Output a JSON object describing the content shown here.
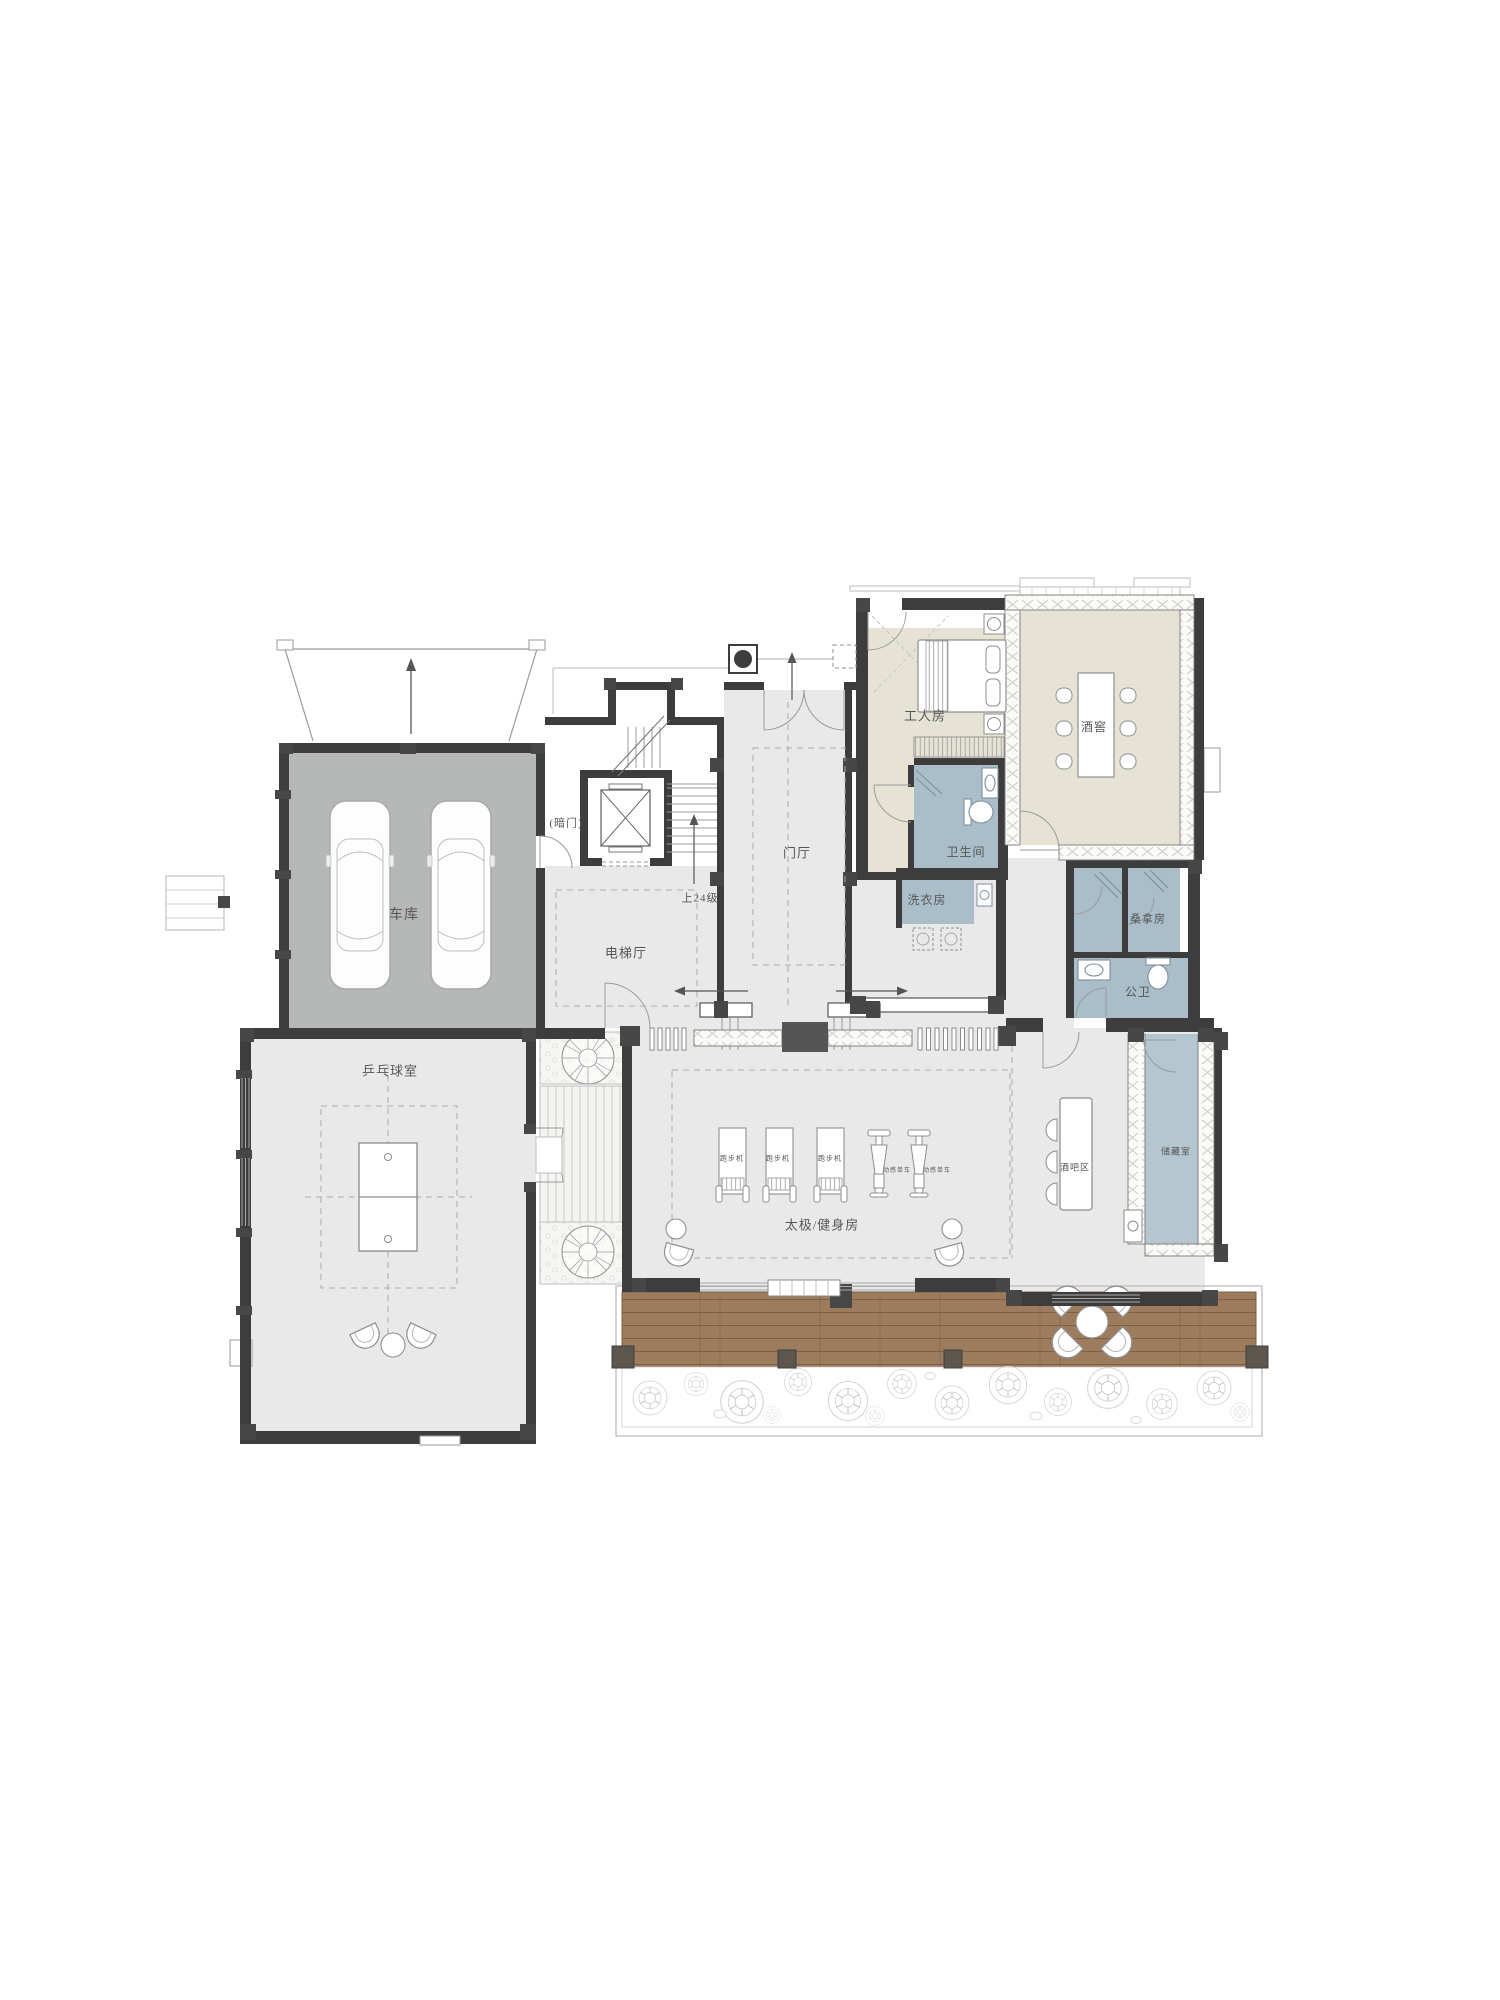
{
  "canvas": {
    "width": 1500,
    "height": 2000,
    "background": "#ffffff"
  },
  "palette": {
    "floor_light": "#e8e9e8",
    "floor_garage": "#b6b8b7",
    "floor_beige": "#e6e3d5",
    "floor_blue": "#a9bec9",
    "floor_storage": "#b4c6d0",
    "deck_wood": "#9d7c5e",
    "wall": "#3d3d3d",
    "pillar": "#474747",
    "text": "#565656"
  },
  "labels": [
    {
      "id": "garage",
      "text": "车库",
      "x": 404,
      "y": 916,
      "fs": 14
    },
    {
      "id": "pingpong-room",
      "text": "乒乓球室",
      "x": 390,
      "y": 1071,
      "fs": 13
    },
    {
      "id": "elevator-hall",
      "text": "电梯厅",
      "x": 626,
      "y": 953,
      "fs": 13
    },
    {
      "id": "foyer",
      "text": "门厅",
      "x": 797,
      "y": 853,
      "fs": 13
    },
    {
      "id": "hidden-door",
      "text": "(暗门)",
      "x": 566,
      "y": 824,
      "fs": 11
    },
    {
      "id": "stairs-up",
      "text": "上24级",
      "x": 700,
      "y": 899,
      "fs": 11
    },
    {
      "id": "worker-room",
      "text": "工人房",
      "x": 925,
      "y": 716,
      "fs": 13
    },
    {
      "id": "bathroom",
      "text": "卫生间",
      "x": 966,
      "y": 852,
      "fs": 12
    },
    {
      "id": "laundry",
      "text": "洗衣房",
      "x": 927,
      "y": 900,
      "fs": 12
    },
    {
      "id": "wine-cellar",
      "text": "酒窖",
      "x": 1094,
      "y": 727,
      "fs": 12
    },
    {
      "id": "sauna",
      "text": "桑拿房",
      "x": 1148,
      "y": 920,
      "fs": 11
    },
    {
      "id": "public-wc",
      "text": "公卫",
      "x": 1138,
      "y": 992,
      "fs": 12
    },
    {
      "id": "taichi-gym",
      "text": "太极/健身房",
      "x": 822,
      "y": 1225,
      "fs": 13
    },
    {
      "id": "bar-area",
      "text": "酒吧区",
      "x": 1075,
      "y": 1168,
      "fs": 9
    },
    {
      "id": "storage",
      "text": "储藏室",
      "x": 1176,
      "y": 1152,
      "fs": 9
    },
    {
      "id": "treadmill-1",
      "text": "跑步机",
      "x": 732,
      "y": 1159,
      "fs": 7
    },
    {
      "id": "treadmill-2",
      "text": "跑步机",
      "x": 778,
      "y": 1159,
      "fs": 7
    },
    {
      "id": "treadmill-3",
      "text": "跑步机",
      "x": 830,
      "y": 1159,
      "fs": 7
    },
    {
      "id": "spin-bike-1",
      "text": "动感单车",
      "x": 897,
      "y": 1171,
      "fs": 6
    },
    {
      "id": "spin-bike-2",
      "text": "动感单车",
      "x": 937,
      "y": 1171,
      "fs": 6
    }
  ]
}
